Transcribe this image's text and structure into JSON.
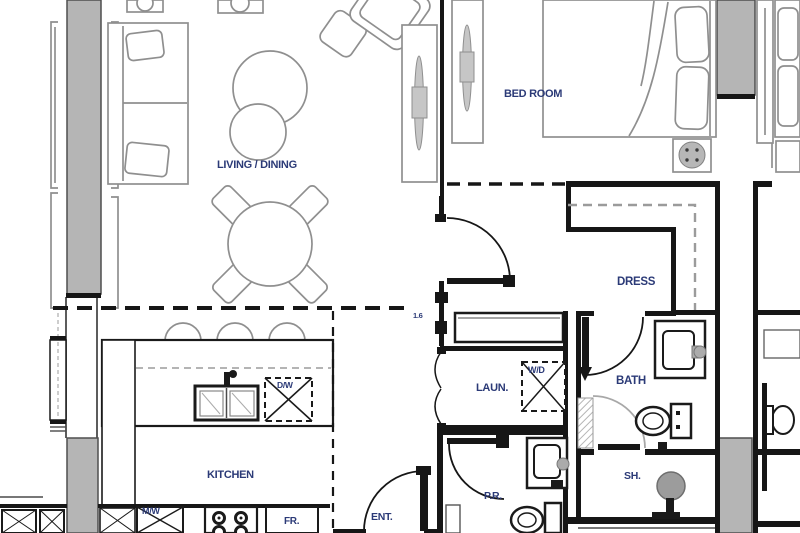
{
  "document": {
    "type": "apartment-floor-plan"
  },
  "colors": {
    "paper": "#ffffff",
    "wall": "#161616",
    "column": "#b5b5b5",
    "columnEdge": "#4f4f4f",
    "furniture": "#8f8f8f",
    "fixture": "#1a1a1a",
    "dashGray": "#9b9b9b",
    "handle": "#c6c6c6",
    "drain": "#9c9c9c",
    "label": "#2b3a77"
  },
  "rooms": {
    "living_dining": {
      "label": "LIVING / DINING"
    },
    "bedroom": {
      "label": "BED ROOM"
    },
    "dress": {
      "label": "DRESS"
    },
    "laundry": {
      "label": "LAUN."
    },
    "bath": {
      "label": "BATH"
    },
    "shower": {
      "label": "SH."
    },
    "powder_room": {
      "label": "P.R."
    },
    "entry": {
      "label": "ENT."
    },
    "kitchen": {
      "label": "KITCHEN"
    }
  },
  "fixtures": {
    "washer_dryer": "W/D",
    "dishwasher": "D/W",
    "microwave": "M/W",
    "fridge": "FR."
  },
  "dimensions": {
    "hall_marker": "1.6"
  }
}
